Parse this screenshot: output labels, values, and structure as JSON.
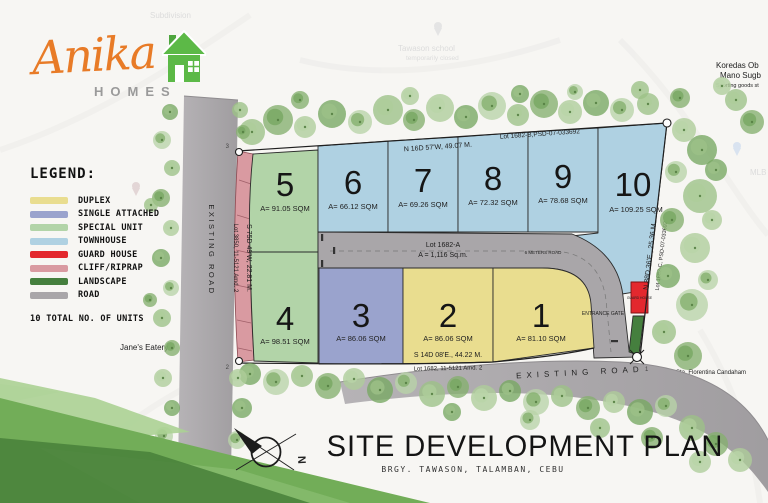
{
  "logo": {
    "brand": "Anika",
    "sub": "HOMES"
  },
  "legend": {
    "title": "LEGEND:",
    "items": [
      {
        "label": "DUPLEX",
        "color": "#e9dd8f"
      },
      {
        "label": "SINGLE ATTACHED",
        "color": "#9aa3cd"
      },
      {
        "label": "SPECIAL UNIT",
        "color": "#b2d4a8"
      },
      {
        "label": "TOWNHOUSE",
        "color": "#afd1e2"
      },
      {
        "label": "GUARD HOUSE",
        "color": "#e3282e"
      },
      {
        "label": "CLIFF/RIPRAP",
        "color": "#d99aa1"
      },
      {
        "label": "LANDSCAPE",
        "color": "#457f3e"
      },
      {
        "label": "ROAD",
        "color": "#a9a6a9"
      }
    ],
    "total_note": "10 TOTAL NO. OF UNITS"
  },
  "plan": {
    "lots": [
      {
        "number": "1",
        "area": "A= 81.10 SQM"
      },
      {
        "number": "2",
        "area": "A= 86.06 SQM"
      },
      {
        "number": "3",
        "area": "A= 86.06 SQM"
      },
      {
        "number": "4",
        "area": "A= 98.51 SQM"
      },
      {
        "number": "5",
        "area": "A= 91.05 SQM"
      },
      {
        "number": "6",
        "area": "A= 66.12 SQM"
      },
      {
        "number": "7",
        "area": "A= 69.26 SQM"
      },
      {
        "number": "8",
        "area": "A= 72.32 SQM"
      },
      {
        "number": "9",
        "area": "A= 78.68 SQM"
      },
      {
        "number": "10",
        "area": "A= 109.25 SQM"
      }
    ],
    "road_lot": {
      "name": "Lot 1682-A",
      "area": "A = 1,116 Sq.m.",
      "width_note": "6 METERS ROAD"
    },
    "boundaries": {
      "top_lot": "Lot 1682-B,PSD-07-033692",
      "top_bearing": "N 16D 57'W, 49.07 M.",
      "right_bearing": "N 88D 36'E., 25.36 M.",
      "right_lot": "Lot 1682-C, PSD-07-033692",
      "left_bearing": "S 75D 49'W, 22.81 M.",
      "left_lot": "Lot 3850, 11-5121 Amd. 2",
      "bottom_bearing": "S 14D 08'E., 44.22 M.",
      "bottom_lot": "Lot 1682, 11-5121 Amd. 2"
    },
    "labels": {
      "existing_road": "EXISTING ROAD",
      "entrance_gate": "ENTRANCE GATE",
      "guard_house": "GUARD HOUSE",
      "north": "N"
    },
    "corners": {
      "c1": "1",
      "c2": "2",
      "c3": "3"
    }
  },
  "title": {
    "main": "SITE DEVELOPMENT PLAN",
    "subtitle": "BRGY. TAWASON, TALAMBAN, CEBU"
  },
  "background": {
    "subdivision": "Subdivision",
    "school_line1": "Tawason school",
    "school_line2": "temporarily closed",
    "poi_line1": "Koredas Ob",
    "poi_line2": "Mano Sugb",
    "poi_line3": "Sporting goods st",
    "mlb": "MLB",
    "eatery": "Jane's Eatery",
    "church": "Sta. Florentina Candaham"
  },
  "colors": {
    "duplex": "#e9dd8f",
    "single_attached": "#9aa3cd",
    "special_unit": "#b2d4a8",
    "townhouse": "#afd1e2",
    "guard_house": "#e3282e",
    "cliff_riprap": "#d99aa1",
    "landscape": "#457f3e",
    "road": "#a9a6a9",
    "brand_orange": "#e87b27",
    "brand_green": "#5cb947"
  }
}
